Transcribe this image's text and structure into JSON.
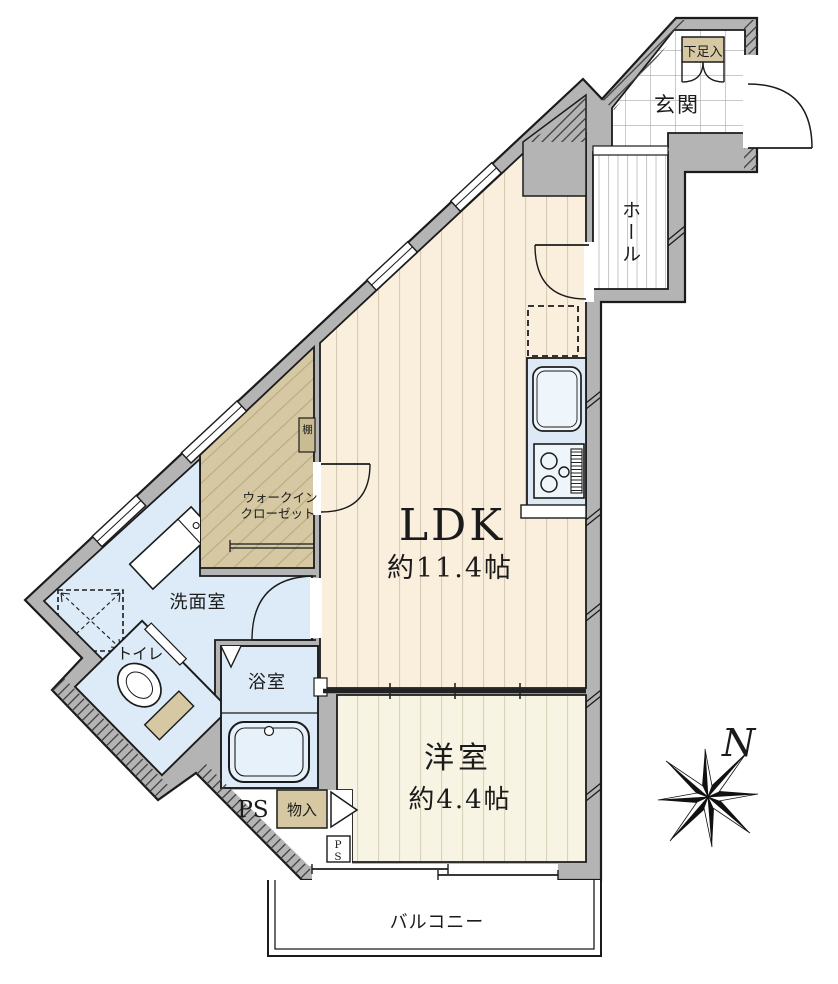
{
  "rooms": {
    "genkan": "玄関",
    "hall": "ホール",
    "ldk": "LDK",
    "ldk_size": "約11.4帖",
    "western_room": "洋室",
    "western_room_size": "約4.4帖",
    "wic_line1": "ウォークイン",
    "wic_line2": "クローゼット",
    "washroom": "洗面室",
    "toilet": "トイレ",
    "bath": "浴室",
    "balcony": "バルコニー"
  },
  "storage": {
    "shoe_cabinet": "下足入",
    "shelf": "棚",
    "closet": "物入",
    "pipe_space": "PS",
    "pipe_space_shaft": "PS"
  },
  "compass": {
    "north": "N"
  },
  "colors": {
    "wall": "#b4b4b4",
    "outline": "#1b1b1b",
    "ldk_floor": "#faeedd",
    "western_floor": "#f8f4e3",
    "wic_floor": "#d5c8a2",
    "wet_area": "#dcebf7",
    "storage_box": "#d5c8a2",
    "kitchen_counter": "#dde9f4"
  }
}
